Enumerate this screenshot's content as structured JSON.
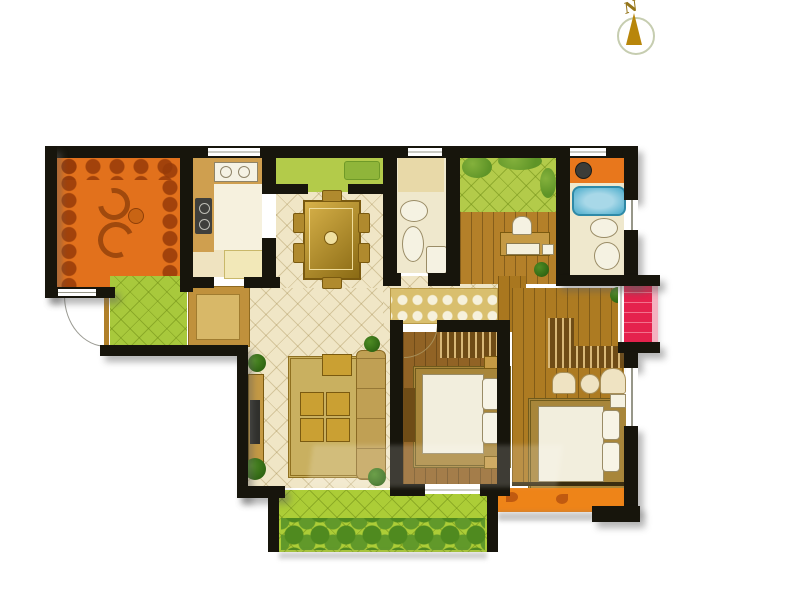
{
  "compass": {
    "label": "N"
  },
  "palette": {
    "wall": "#17150c",
    "floor_cream": "#f0e6c6",
    "terrace_orange": "#e2711c",
    "kitchen_base": "#efe3c0",
    "kitchen_tile": "#f6f1de",
    "counter_tan": "#cf9f4f",
    "garden_green": "#b3cb4a",
    "entry_green": "#a8c93c",
    "balcony_green": "#accd37",
    "balcony_orange": "#ee8418",
    "balcony_red": "#e5224d",
    "study_wood": "#b48029",
    "bedroom_wood": "#916325",
    "master_wood": "#ad7b22",
    "corridor_wood": "#a9771f",
    "bath_floor": "#efe8cd",
    "tub_blue": "#5fb6d2",
    "vanity_orange": "#e8771c",
    "runner_tan": "#d9bf6e",
    "rug_gold": "#c9b060",
    "bed_rug_gold": "#a8863a",
    "table_gold": "#caa033",
    "wardrobe_brown": "#6f4c16",
    "compass_gold": "#b8860b"
  }
}
